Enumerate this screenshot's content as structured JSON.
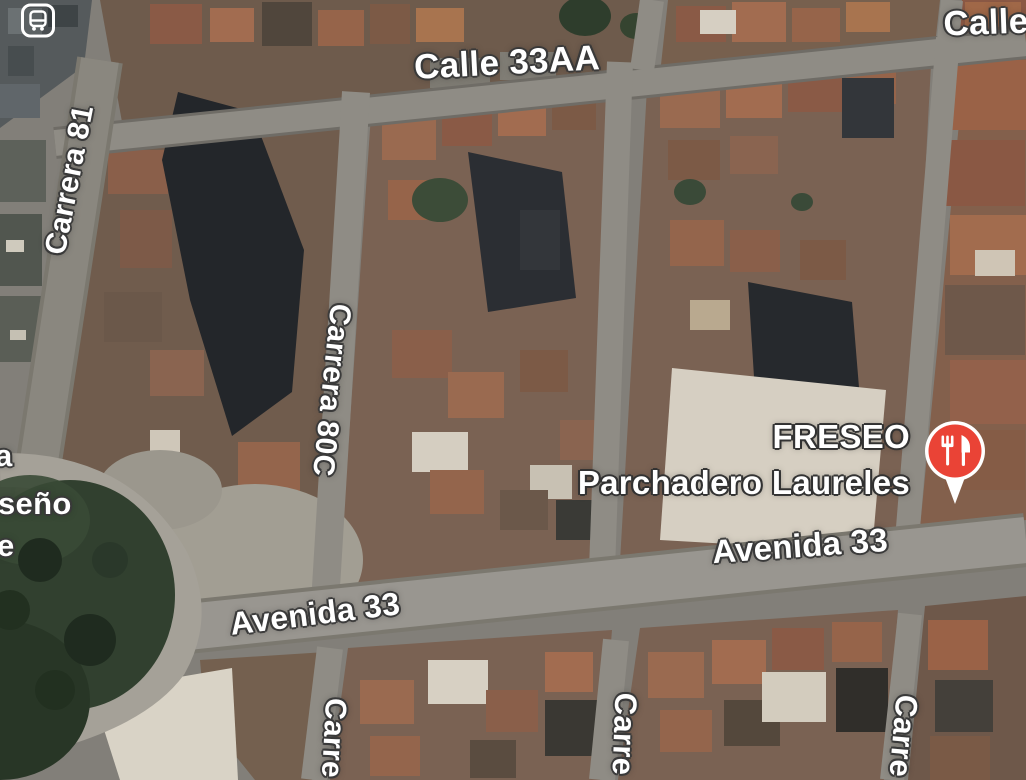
{
  "view": {
    "kind": "satellite-map",
    "city_area": "Laureles street grid with Avenida 33 corridor, park roundabout bottom-left"
  },
  "streets": [
    {
      "id": "calle-33aa",
      "text": "Calle 33AA"
    },
    {
      "id": "calle-top-right",
      "text": "Calle"
    },
    {
      "id": "carrera-81",
      "text": "Carrera 81"
    },
    {
      "id": "carrera-80c",
      "text": "Carrera 80C"
    },
    {
      "id": "avenida-33-right",
      "text": "Avenida 33"
    },
    {
      "id": "avenida-33-left",
      "text": "Avenida 33"
    },
    {
      "id": "carrera-bottom-left",
      "text": "Carre"
    },
    {
      "id": "carrera-bottom-mid",
      "text": "Carre"
    },
    {
      "id": "carrera-bottom-right",
      "text": "Carre"
    }
  ],
  "poi": {
    "title": "FRESEO",
    "subtitle": "Parchadero Laureles",
    "category": "restaurant",
    "marker_color": "#EA4336"
  },
  "edge_fragments": [
    {
      "text": "a"
    },
    {
      "text": "seño"
    },
    {
      "text": "e"
    }
  ],
  "icons": {
    "transit_station": "bus-front-glyph",
    "restaurant_pin": "fork-and-knife-glyph"
  },
  "colors": {
    "label_text": "#FFFFFF",
    "label_outline": "#3A3A3A",
    "pin_red": "#EA4336",
    "pin_white": "#FFFFFF",
    "road_gray": "#8F8C85",
    "avenue_gray": "#999690",
    "park_green": "#31402F",
    "roof_rust": "#9A6A50",
    "building_shadow": "#24272B",
    "white_roof": "#D6CFC2"
  }
}
